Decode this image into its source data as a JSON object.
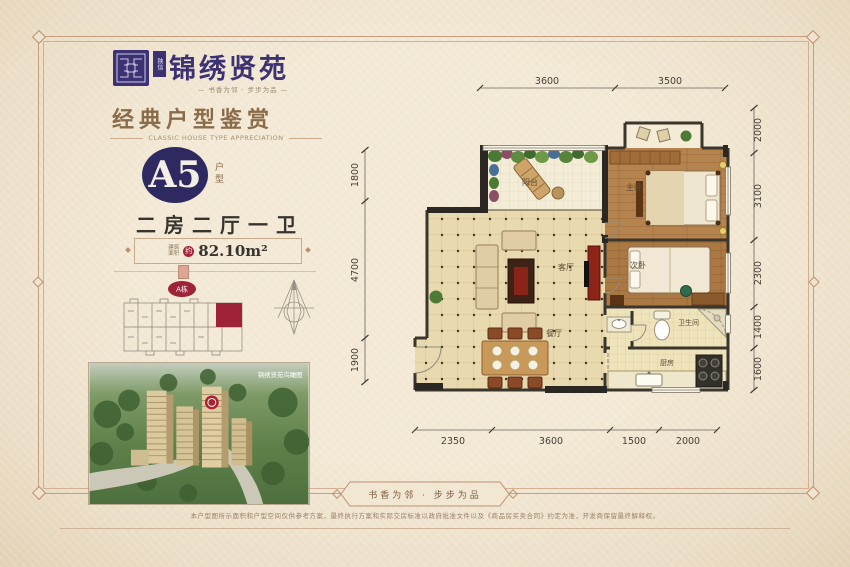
{
  "brand": {
    "vertical_mark": "陕信",
    "name": "锦绣贤苑",
    "tagline": "—  书香为邻 · 步步为品  —"
  },
  "section": {
    "title": "经典户型鉴赏",
    "subtitle": "CLASSIC HOUSE TYPE APPRECIATION"
  },
  "unit": {
    "code": "A5",
    "code_label": "户型",
    "rooms_desc": "二房二厅一卫",
    "area_prefix_l1": "建筑",
    "area_prefix_l2": "面积",
    "area_approx": "约",
    "area_value": "82.10m²"
  },
  "keyplan": {
    "badge": "A栋"
  },
  "aerial": {
    "caption": "锦绣贤苑鸟瞰图"
  },
  "floorplan": {
    "labels": {
      "balcony": "阳台",
      "master": "主卧",
      "living": "客厅",
      "second": "次卧",
      "dining": "餐厅",
      "bath": "卫生间",
      "kitchen": "厨房"
    },
    "dims_top": [
      "3600",
      "3500"
    ],
    "dims_left": [
      "1800",
      "4700",
      "1900"
    ],
    "dims_right": [
      "2000",
      "3100",
      "2300",
      "1400",
      "1600"
    ],
    "dims_bottom": [
      "2350",
      "3600",
      "1500",
      "2000"
    ]
  },
  "footer": {
    "slogan": "书香为邻 · 步步为品",
    "disclaimer": "本户型图所示面积和户型空间仅供参考方案，最终执行方案和实际交房标准以政府批准文件以及《商品房买卖合同》约定为准，开发商保留最终解释权。"
  },
  "colors": {
    "accent_red": "#a3253c",
    "navy": "#2e2960",
    "brown": "#8a6b4a"
  }
}
